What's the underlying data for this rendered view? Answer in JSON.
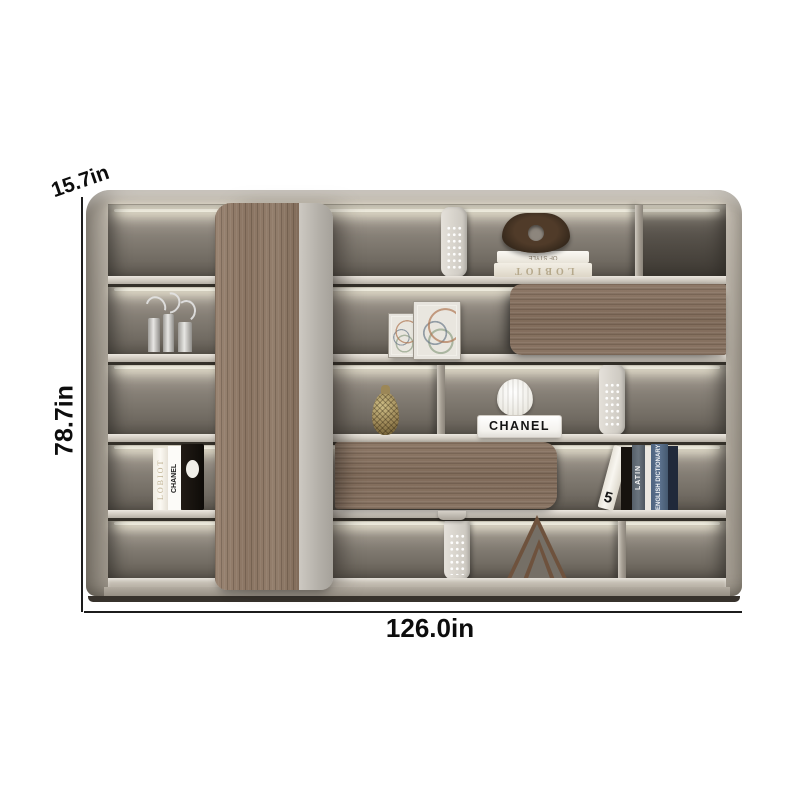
{
  "annotations": {
    "depth_label": "15.7in",
    "height_label": "78.7in",
    "width_label": "126.0in"
  },
  "decor_text": {
    "stacked_book_top": "CHANEL · THE VOCABULARY OF STYLE",
    "stacked_book_bottom": "LOBIOT",
    "left_book_1": "LOBIOT",
    "left_book_2": "CHANEL",
    "chanel_tray": "CHANEL",
    "leaning_book_number": "5",
    "right_book_latin": "LATIN",
    "right_book_dictionary": "ENGLISH DICTIONARY"
  },
  "colors": {
    "frame": "#b9b2a7",
    "wood_panel": "#8a7463",
    "interior_back": "#7d766d",
    "led_glow": "#fff6e0",
    "annotation_text": "#111111"
  }
}
